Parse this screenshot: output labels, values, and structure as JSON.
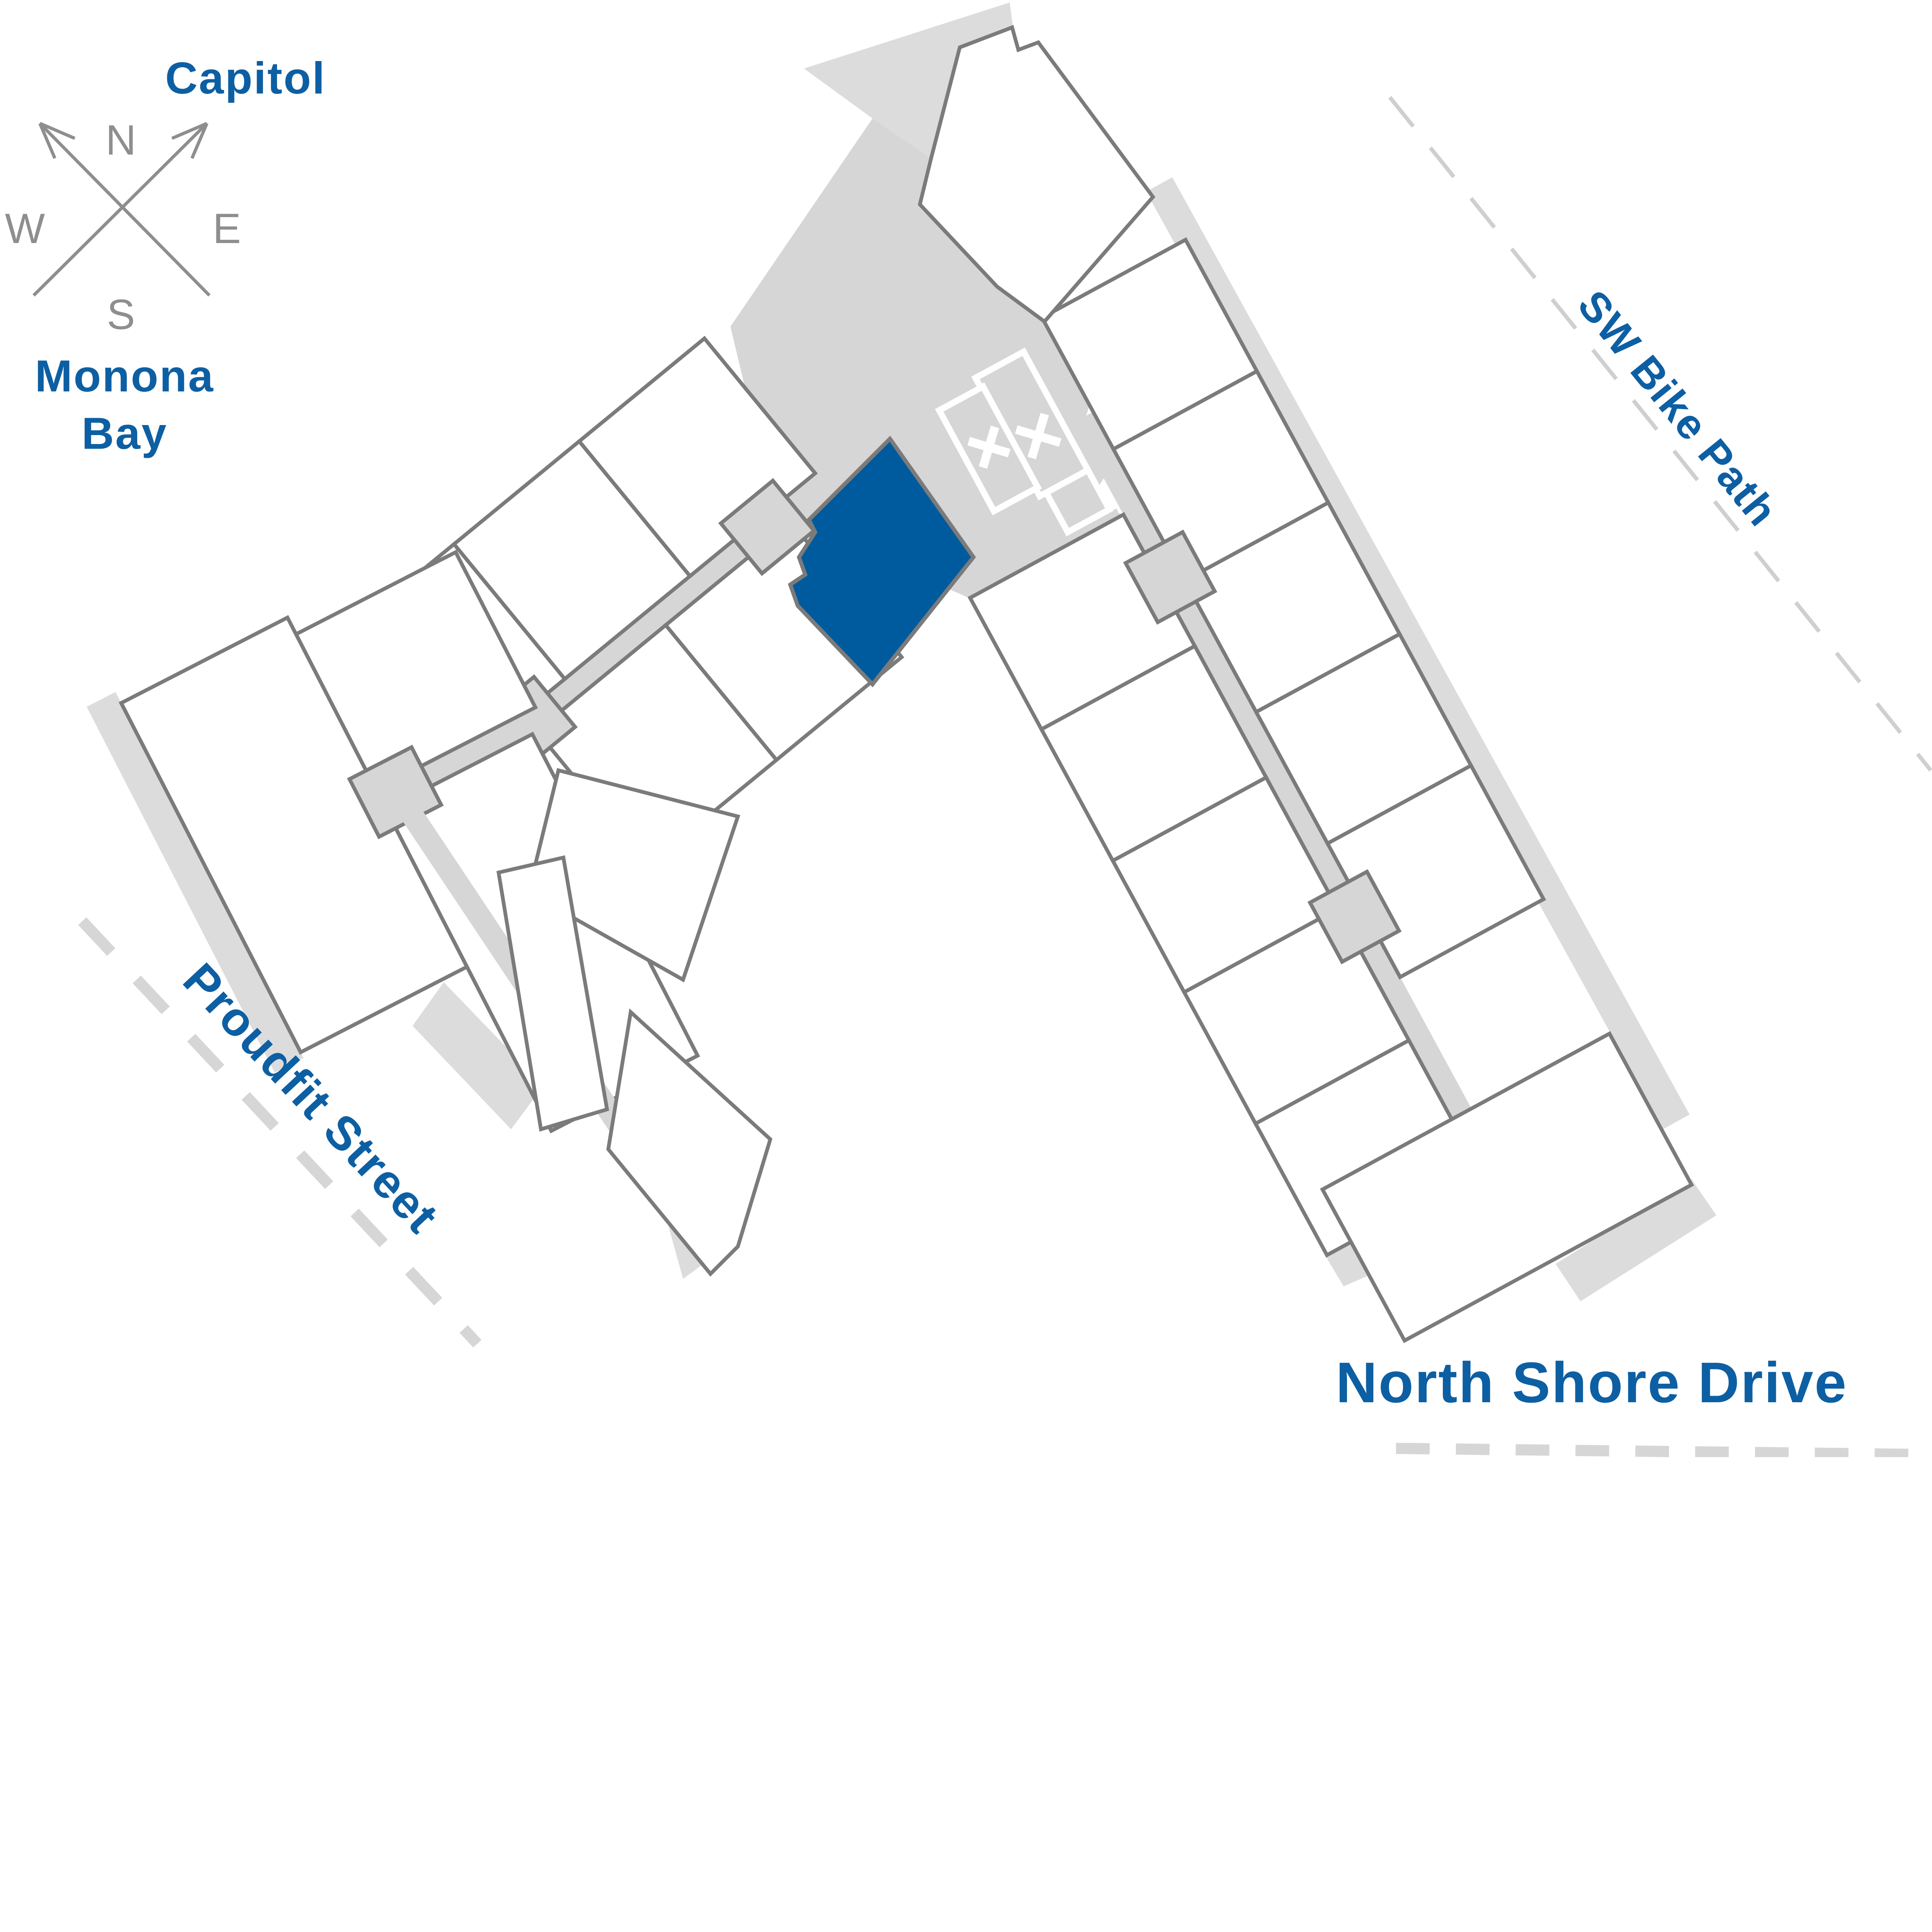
{
  "map": {
    "compass": {
      "north": "N",
      "east": "E",
      "south": "S",
      "west": "W"
    },
    "labels": {
      "capitol": "Capitol",
      "monona_line1": "Monona",
      "monona_line2": "Bay",
      "sw_bike_path": "SW Bike Path",
      "proudfit_street": "Proudfit Street",
      "north_shore_drive": "North Shore Drive"
    },
    "highlighted_unit": {
      "state": "selected",
      "fill": "#005b9e"
    },
    "stair_rooms": {
      "mark": "X",
      "count": 2
    },
    "colors": {
      "label_blue": "#0d5fa3",
      "unit_outline_gray": "#7b7b7b",
      "floor_gray": "#d6d6d6",
      "shadow_gray": "#dcdcdc",
      "road_dash_gray": "#d6d6d6",
      "bike_dash_gray": "#cfcfcf",
      "compass_gray": "#8e8e8e",
      "background": "#ffffff",
      "unit_fill": "#ffffff",
      "highlight_blue": "#005b9e"
    }
  }
}
